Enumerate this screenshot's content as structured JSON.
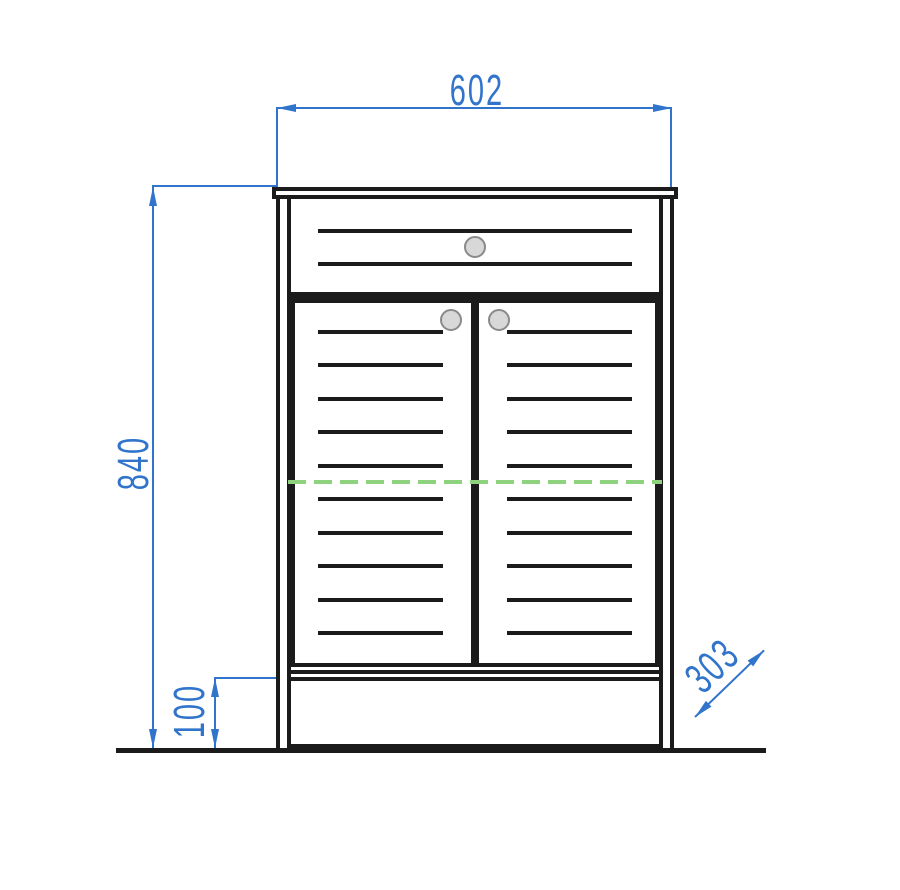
{
  "dimensions": {
    "width": {
      "value": "602",
      "orientation": "horizontal-top"
    },
    "height": {
      "value": "840",
      "orientation": "vertical-left"
    },
    "plinth_height": {
      "value": "100",
      "orientation": "vertical-left-bottom"
    },
    "depth": {
      "value": "303",
      "orientation": "diagonal-right-bottom"
    }
  },
  "colors": {
    "dimension_blue": "#3174cc",
    "centerline_green": "#8ed27f",
    "outline_black": "#1b1b1b",
    "knob_fill": "#d8d8d8",
    "knob_stroke": "#8a8a8a",
    "background": "#ffffff"
  },
  "cabinet": {
    "drawer": {
      "slat_count": 2,
      "knob_count": 1
    },
    "left_door": {
      "slat_count": 10,
      "knob_count": 1
    },
    "right_door": {
      "slat_count": 10,
      "knob_count": 1
    },
    "doors": 2,
    "has_countertop": true,
    "has_plinth": true,
    "has_centerline": true
  }
}
